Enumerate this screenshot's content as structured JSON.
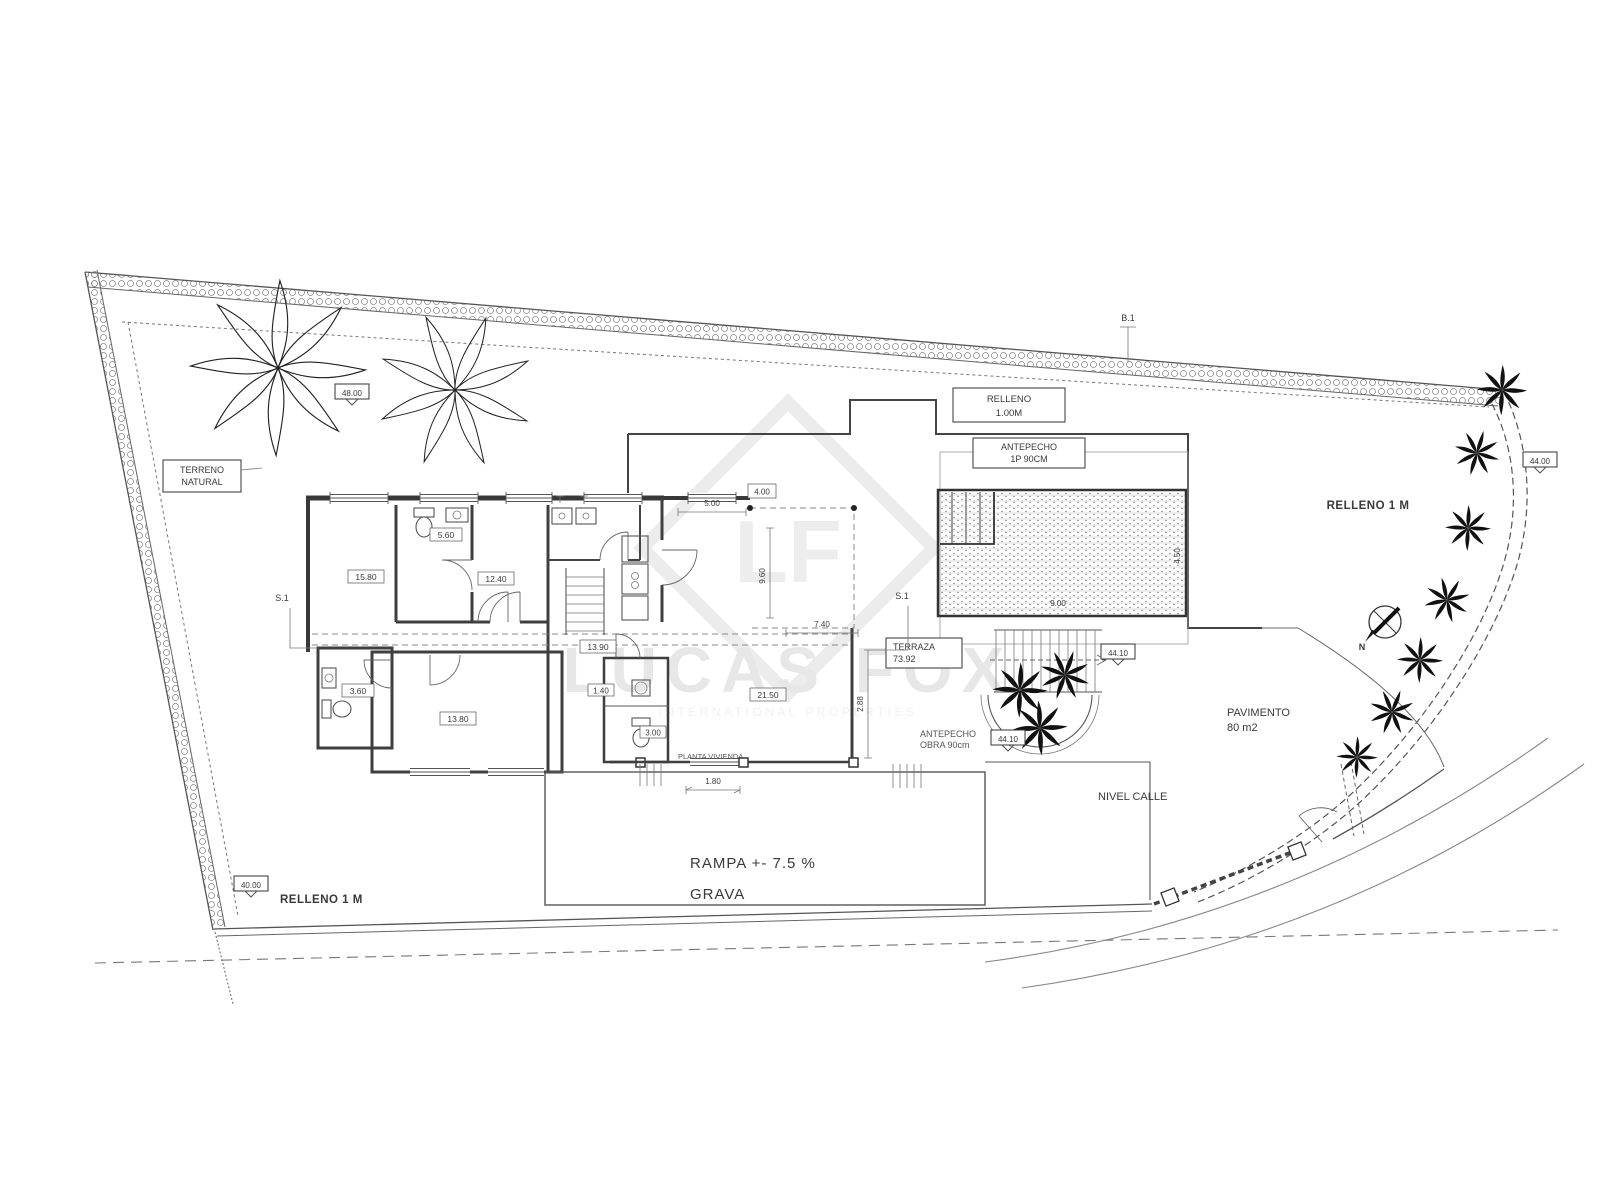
{
  "drawing": {
    "watermark": {
      "logo": "LF",
      "name": "LUCAS FOX",
      "tagline": "INTERNATIONAL PROPERTIES"
    },
    "labels": {
      "terreno_l1": "TERRENO",
      "terreno_l2": "NATURAL",
      "relleno_top_l1": "RELLENO",
      "relleno_top_l2": "1.00M",
      "antepecho_pool_l1": "ANTEPECHO",
      "antepecho_pool_l2": "1P 90CM",
      "terraza_l1": "TERRAZA",
      "terraza_l2": "73.92",
      "antepecho_obra_l1": "ANTEPECHO",
      "antepecho_obra_l2": "OBRA 90cm",
      "relleno_right": "RELLENO 1 M",
      "pavimento_l1": "PAVIMENTO",
      "pavimento_l2": "80 m2",
      "nivel_calle": "NIVEL CALLE",
      "rampa": "RAMPA +- 7.5 %",
      "grava": "GRAVA",
      "relleno_bottom": "RELLENO 1 M",
      "planta_note": "PLANTA VIVIENDA"
    },
    "levels": {
      "garden": "48.00",
      "bottom": "40.00",
      "stairs": "44.10",
      "planter": "44.10",
      "street_edge": "44.00"
    },
    "markers": {
      "top": "B.1",
      "left": "S.1",
      "terrace": "S.1"
    },
    "compass_n": "N",
    "rooms": {
      "bed1": "15.80",
      "bath1": "5.60",
      "bed2": "12.40",
      "utility": "3.60",
      "master": "13.80",
      "hall": "13.90",
      "living": "21.50",
      "wc1": "1.40",
      "wc2": "3.00"
    },
    "dims": {
      "d1": "5.00",
      "d2": "4.00",
      "d3": "9.60",
      "d4": "7.40",
      "d5": "1.80",
      "d6": "2.88",
      "pool_w": "9.00",
      "pool_d": "4.50"
    }
  }
}
